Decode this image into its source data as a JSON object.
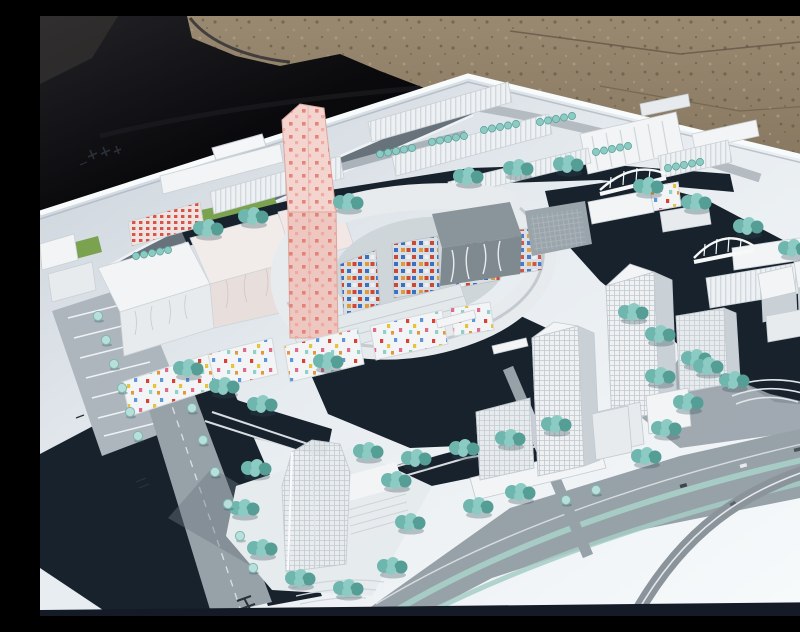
{
  "scene": {
    "type": "outdoor-photograph",
    "description": "Architectural scale model of a waterfront urban district on a white baseboard, photographed outdoors; black tarp at upper left, brown gravel ground at upper right; white model buildings, teal model trees, dark navy canals, gray roads",
    "visible_text": "",
    "road_markings_legible": false
  },
  "palette": {
    "gravel": "#94836c",
    "gravel_dark": "#6b5c49",
    "gravel_light": "#a5947c",
    "tarp": "#0b0b0e",
    "tarp_fold": "#3a3733",
    "board": "#e9eef2",
    "board_shadow": "#c9d1d9",
    "board_bright": "#f8fbfc",
    "water": "#17222d",
    "water_edge": "#2a454e",
    "road": "#97a1a8",
    "road_dark": "#68727b",
    "road_light": "#b4bcc2",
    "median_teal": "#a6ccc5",
    "tree": "#6fb7ae",
    "tree_light": "#8ccbc3",
    "tree_dark": "#549e95",
    "tree_pale": "#b9dfdb",
    "lawn": "#7aa24f",
    "bldg_white": "#f2f4f5",
    "bldg_face": "#e7ebee",
    "bldg_side": "#c9d0d6",
    "bldg_glass": "#8a949b",
    "pink_tower": "#eec7c1",
    "pink_dot": "#e2776b",
    "mosaic_blue": "#3b6fc4",
    "mosaic_red": "#cf4633",
    "mosaic_orange": "#e09a3c",
    "confetti_yellow": "#e6c33f",
    "confetti_pink": "#e06a8a",
    "confetti_blue": "#5f96d8",
    "confetti_red": "#d94233",
    "bridge_white": "#f6f8f9",
    "mark_dark": "#2a3138",
    "photo_edge": "#141b26"
  },
  "elements": [
    {
      "name": "gravel-ground",
      "note": "bare dirt ground, upper right"
    },
    {
      "name": "black-tarp-cover",
      "note": "dark cloth draped upper left"
    },
    {
      "name": "model-baseboard",
      "note": "white display board in perspective"
    },
    {
      "name": "canal-network",
      "note": "dark navy water channels around centre island"
    },
    {
      "name": "pink-spotted-tower",
      "note": "tall leaning pink tower with red dots"
    },
    {
      "name": "circular-courtyard-complex",
      "note": "ring-shaped block with colourful mosaic facades"
    },
    {
      "name": "confetti-residential-band",
      "note": "white low-rises with multicolour window dots"
    },
    {
      "name": "wavy-facade-complex",
      "note": "large white slabs, west side"
    },
    {
      "name": "red-window-slab",
      "note": "slab with red window grid"
    },
    {
      "name": "north-industrial-rows",
      "note": "sawtooth-roof rows along top"
    },
    {
      "name": "office-tower-west-cluster",
      "note": "gridded white towers, centre right"
    },
    {
      "name": "office-tower-east-cluster",
      "note": "tall gridded tower and slabs, right"
    },
    {
      "name": "cubic-blocks-cluster",
      "note": "jumble of white cubes, right edge"
    },
    {
      "name": "translucent-tower",
      "note": "tall translucent tower, bottom centre"
    },
    {
      "name": "lattice-arch-bridge",
      "note": "white lattice bridge over canal"
    },
    {
      "name": "arch-bridge",
      "note": "white arched bridge, right canal"
    },
    {
      "name": "boulevard",
      "note": "wide grey avenue with teal medians, bottom right"
    },
    {
      "name": "diagonal-road",
      "note": "grey road, bottom left"
    },
    {
      "name": "parking-area",
      "note": "striped parking rows, west edge"
    },
    {
      "name": "tree-clusters",
      "note": "teal foliage lining canals and roads"
    },
    {
      "name": "board-logo-marks",
      "note": "small illegible dark glyphs on board, upper left"
    },
    {
      "name": "road-glyph-marks",
      "note": "tiny illegible markings painted on roads"
    }
  ]
}
